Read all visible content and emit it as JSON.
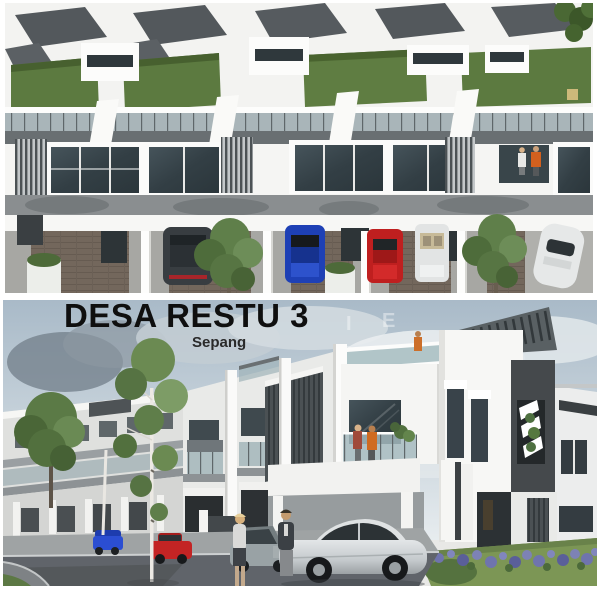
{
  "header": {
    "title": "DESA RESTU 3",
    "subtitle": "Sepang",
    "title_color": "#0f0f0f"
  },
  "watermark": {
    "color": "#ffffff",
    "letters": [
      "I",
      "E",
      "S",
      "Y",
      "A"
    ]
  },
  "panels": {
    "top": {
      "kind": "aerial 3d render of triple-storey terrace houses",
      "cars": [
        "dark-grey",
        "blue",
        "red",
        "white-convertible",
        "white-coupe"
      ],
      "people": [
        "white-shirt",
        "orange-shirt"
      ]
    },
    "bottom": {
      "kind": "street-level 3d render of terrace houses",
      "cars": [
        "blue",
        "red",
        "grey",
        "silver-coupe"
      ],
      "people": [
        "woman-walking",
        "man-standing",
        "balcony-pair",
        "roof-figure"
      ]
    }
  },
  "palette": {
    "roof_dark": "#53585c",
    "wall_white": "#f6f6f4",
    "roof_garden_green": "#5c7a40",
    "glass_dark": "#374247",
    "railing_glass": "#a7b4b9",
    "brick_paving": "#73675c",
    "sky_top": "#a9bac8",
    "asphalt": "#60646a",
    "lawn_green": "#7c9655",
    "flower_purple": "#7d82b5",
    "accent_panel_dark": "#45494c",
    "car_blue": "#1e40b5",
    "car_red": "#c32424",
    "car_silver": "#cdd1d3",
    "people_orange": "#cf6b21"
  }
}
